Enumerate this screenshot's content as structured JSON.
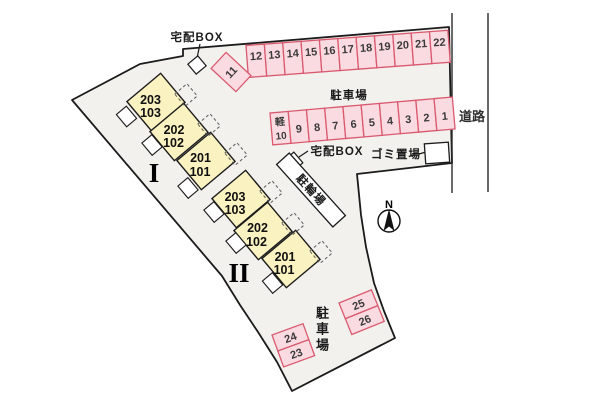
{
  "site": {
    "road_label": "道路",
    "colors": {
      "site_fill": "#f2f1ee",
      "outline": "#1b1b1b",
      "stall_fill": "#fadbe1",
      "stall_stroke": "#d9596f",
      "building_fill": "#faf2c0",
      "porch_fill": "#ffffff"
    }
  },
  "landmarks": {
    "delivery_box_top": "宅配BOX",
    "delivery_box_mid": "宅配BOX",
    "garbage_area": "ゴミ置場",
    "bicycle_parking": "駐輪場",
    "parking_lot_top": "駐車場",
    "parking_lot_bottom": "駐車場",
    "north_label": "N"
  },
  "parking": {
    "stall_11": "11",
    "row_top": [
      "12",
      "13",
      "14",
      "15",
      "16",
      "17",
      "18",
      "19",
      "20",
      "21",
      "22"
    ],
    "kei_label": "軽",
    "row_mid": [
      "10",
      "9",
      "8",
      "7",
      "6",
      "5",
      "4",
      "3",
      "2",
      "1"
    ],
    "block_left": [
      "24",
      "23"
    ],
    "block_right": [
      "25",
      "26"
    ]
  },
  "buildings": {
    "b1": {
      "name": "I",
      "units": [
        {
          "upper": "203",
          "lower": "103"
        },
        {
          "upper": "202",
          "lower": "102"
        },
        {
          "upper": "201",
          "lower": "101"
        }
      ]
    },
    "b2": {
      "name": "II",
      "units": [
        {
          "upper": "203",
          "lower": "103"
        },
        {
          "upper": "202",
          "lower": "102"
        },
        {
          "upper": "201",
          "lower": "101"
        }
      ]
    }
  }
}
